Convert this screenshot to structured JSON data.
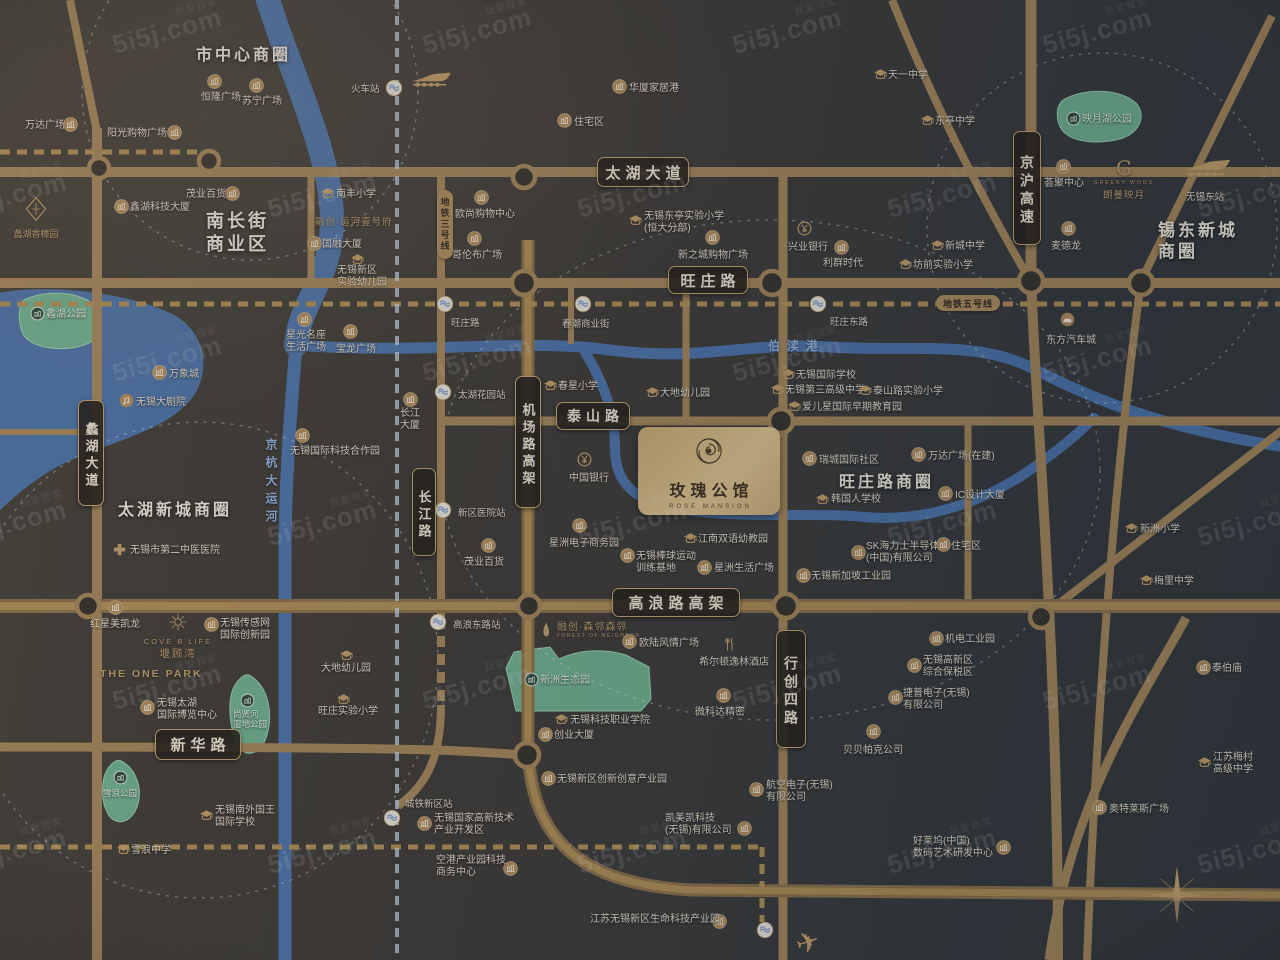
{
  "project": {
    "name": "玫瑰公馆",
    "en": "ROSE MANSION"
  },
  "watermark": {
    "brand": "5i5j.com",
    "cn": "我爱我家"
  },
  "logos": {
    "xiangzhang": "蠡湖香樟园",
    "yunhe": "融创·运河壹号府",
    "cove_en": "COVE B LIFE",
    "cove_cn": "堰顾湾",
    "onepark": "THE ONE PARK",
    "g_letter": "G",
    "g_en": "GREENY WOOD",
    "g_cn": "朗曼映月",
    "senlin_cn": "融创·森邻森邻",
    "senlin_en": "FOREST OF NEIGHBOR"
  },
  "districts": [
    {
      "ln": [
        "市中心商圈"
      ],
      "x": 196,
      "y": 46,
      "fs": 16
    },
    {
      "ln": [
        "南长街",
        "商业区"
      ],
      "x": 206,
      "y": 210,
      "fs": 18
    },
    {
      "ln": [
        "太湖新城商圈"
      ],
      "x": 118,
      "y": 501,
      "fs": 16
    },
    {
      "ln": [
        "旺庄路商圈"
      ],
      "x": 839,
      "y": 473,
      "fs": 16
    },
    {
      "ln": [
        "锡东新城",
        "商圈"
      ],
      "x": 1158,
      "y": 220,
      "fs": 17
    }
  ],
  "road_labels": [
    {
      "t": "太湖大道",
      "x": 597,
      "y": 157,
      "w": 92,
      "h": 30,
      "fs": 15,
      "v": 0
    },
    {
      "t": "旺庄路",
      "x": 668,
      "y": 266,
      "w": 80,
      "h": 28,
      "fs": 15,
      "v": 0
    },
    {
      "t": "泰山路",
      "x": 556,
      "y": 402,
      "w": 74,
      "h": 28,
      "fs": 14,
      "v": 0
    },
    {
      "t": "高浪路高架",
      "x": 612,
      "y": 588,
      "w": 128,
      "h": 29,
      "fs": 15,
      "v": 0
    },
    {
      "t": "新华路",
      "x": 155,
      "y": 729,
      "w": 86,
      "h": 31,
      "fs": 15,
      "v": 0
    },
    {
      "t": "蠡湖大道",
      "x": 78,
      "y": 400,
      "w": 26,
      "h": 106,
      "fs": 13,
      "v": 1
    },
    {
      "t": "长江路",
      "x": 412,
      "y": 468,
      "w": 24,
      "h": 88,
      "fs": 13,
      "v": 1
    },
    {
      "t": "机场路高架",
      "x": 515,
      "y": 376,
      "w": 26,
      "h": 132,
      "fs": 13,
      "v": 1
    },
    {
      "t": "京沪高速",
      "x": 1013,
      "y": 131,
      "w": 28,
      "h": 114,
      "fs": 14,
      "v": 1
    },
    {
      "t": "行创四路",
      "x": 776,
      "y": 630,
      "w": 30,
      "h": 118,
      "fs": 14,
      "v": 1
    }
  ],
  "metro_labels": [
    {
      "t": "地铁三号线",
      "x": 437,
      "y": 190,
      "v": 1
    },
    {
      "t": "地铁五号线",
      "x": 936,
      "y": 295,
      "v": 0
    }
  ],
  "river_labels": [
    {
      "t": "伯渎港",
      "x": 768,
      "y": 337,
      "v": 0
    },
    {
      "t": "京杭大运河",
      "x": 263,
      "y": 438,
      "v": 1
    }
  ],
  "plain_texts": [
    {
      "t": "无锡东站",
      "x": 1186,
      "y": 189
    }
  ],
  "stations": [
    {
      "x": 394,
      "y": 88,
      "t": "火车站",
      "tx": 351,
      "ty": 81
    },
    {
      "x": 445,
      "y": 304,
      "t": "旺庄路",
      "tx": 451,
      "ty": 315
    },
    {
      "x": 583,
      "y": 304,
      "t": "春潮商业街",
      "tx": 562,
      "ty": 316
    },
    {
      "x": 818,
      "y": 304,
      "t": "旺庄东路",
      "tx": 830,
      "ty": 314
    },
    {
      "x": 443,
      "y": 392,
      "t": "太湖花园站",
      "tx": 458,
      "ty": 387
    },
    {
      "x": 443,
      "y": 510,
      "t": "新区医院站",
      "tx": 458,
      "ty": 505
    },
    {
      "x": 438,
      "y": 622,
      "t": "高浪东路站",
      "tx": 453,
      "ty": 617
    },
    {
      "x": 392,
      "y": 818,
      "t": "城铁新区站",
      "tx": 405,
      "ty": 796
    },
    {
      "x": 765,
      "y": 930,
      "t": "",
      "tx": 0,
      "ty": 0
    }
  ],
  "pois": [
    {
      "i": "b",
      "ix": 63,
      "iy": 117,
      "tx": 25,
      "ty": 120,
      "ln": [
        "万达广场"
      ]
    },
    {
      "i": "b",
      "ix": 167,
      "iy": 125,
      "tx": 107,
      "ty": 128,
      "ln": [
        "阳光购物广场"
      ]
    },
    {
      "i": "b",
      "ix": 207,
      "iy": 74,
      "tx": 201,
      "ty": 92,
      "ln": [
        "恒隆广场"
      ]
    },
    {
      "i": "b",
      "ix": 249,
      "iy": 78,
      "tx": 242,
      "ty": 96,
      "ln": [
        "苏宁广场"
      ]
    },
    {
      "i": "b",
      "ix": 225,
      "iy": 186,
      "tx": 186,
      "ty": 189,
      "ln": [
        "茂业百货"
      ]
    },
    {
      "i": "b",
      "ix": 114,
      "iy": 199,
      "tx": 130,
      "ty": 202,
      "ln": [
        "鑫湖科技大厦"
      ]
    },
    {
      "i": "b",
      "ix": 152,
      "iy": 365,
      "tx": 169,
      "ty": 369,
      "ln": [
        "万象城"
      ]
    },
    {
      "i": "th",
      "ix": 119,
      "iy": 393,
      "tx": 136,
      "ty": 397,
      "ln": [
        "无锡大剧院"
      ]
    },
    {
      "i": "b",
      "ix": 297,
      "iy": 312,
      "tx": 286,
      "ty": 330,
      "ln": [
        "星光名座",
        "生活广场"
      ]
    },
    {
      "i": "b",
      "ix": 343,
      "iy": 324,
      "tx": 336,
      "ty": 344,
      "ln": [
        "宝龙广场"
      ]
    },
    {
      "i": "b",
      "ix": 612,
      "iy": 79,
      "tx": 629,
      "ty": 83,
      "ln": [
        "华厦家居港"
      ]
    },
    {
      "i": "b",
      "ix": 557,
      "iy": 113,
      "tx": 574,
      "ty": 117,
      "ln": [
        "住宅区"
      ]
    },
    {
      "i": "b",
      "ix": 474,
      "iy": 190,
      "tx": 455,
      "ty": 209,
      "ln": [
        "欧尚购物中心"
      ]
    },
    {
      "i": "b",
      "ix": 467,
      "iy": 231,
      "tx": 452,
      "ty": 250,
      "ln": [
        "哥伦布广场"
      ]
    },
    {
      "i": "b",
      "ix": 307,
      "iy": 236,
      "tx": 322,
      "ty": 239,
      "ln": [
        "国融大厦"
      ]
    },
    {
      "i": "b",
      "ix": 705,
      "iy": 230,
      "tx": 678,
      "ty": 250,
      "ln": [
        "新之城购物广场"
      ]
    },
    {
      "i": "b",
      "ix": 834,
      "iy": 240,
      "tx": 823,
      "ty": 258,
      "ln": [
        "利群时代"
      ]
    },
    {
      "i": "bank",
      "ix": 797,
      "iy": 221,
      "tx": 788,
      "ty": 242,
      "ln": [
        "兴业银行"
      ]
    },
    {
      "i": "b",
      "ix": 1056,
      "iy": 159,
      "tx": 1044,
      "ty": 178,
      "ln": [
        "荟聚中心"
      ]
    },
    {
      "i": "b",
      "ix": 1061,
      "iy": 221,
      "tx": 1051,
      "ty": 241,
      "ln": [
        "麦德龙"
      ]
    },
    {
      "i": "b",
      "ix": 403,
      "iy": 392,
      "tx": 400,
      "ty": 408,
      "ln": [
        "长江",
        "大厦"
      ]
    },
    {
      "i": "b",
      "ix": 481,
      "iy": 538,
      "tx": 464,
      "ty": 557,
      "ln": [
        "茂业百货"
      ]
    },
    {
      "i": "b",
      "ix": 802,
      "iy": 451,
      "tx": 819,
      "ty": 455,
      "ln": [
        "瑞城国际社区"
      ]
    },
    {
      "i": "b",
      "ix": 911,
      "iy": 447,
      "tx": 928,
      "ty": 451,
      "ln": [
        "万达广场(在建)"
      ]
    },
    {
      "i": "b",
      "ix": 938,
      "iy": 486,
      "tx": 955,
      "ty": 490,
      "ln": [
        "IC设计大厦"
      ]
    },
    {
      "i": "b",
      "ix": 572,
      "iy": 518,
      "tx": 549,
      "ty": 538,
      "ln": [
        "星洲电子商务园"
      ]
    },
    {
      "i": "bank",
      "ix": 577,
      "iy": 452,
      "tx": 569,
      "ty": 473,
      "ln": [
        "中国银行"
      ]
    },
    {
      "i": "b",
      "ix": 851,
      "iy": 545,
      "tx": 866,
      "ty": 541,
      "ln": [
        "SK海力士半导体",
        "(中国)有限公司"
      ]
    },
    {
      "i": "b",
      "ix": 936,
      "iy": 537,
      "tx": 951,
      "ty": 541,
      "ln": [
        "住宅区"
      ]
    },
    {
      "i": "b",
      "ix": 796,
      "iy": 568,
      "tx": 811,
      "ty": 571,
      "ln": [
        "无锡新加坡工业园"
      ]
    },
    {
      "i": "b",
      "ix": 929,
      "iy": 631,
      "tx": 945,
      "ty": 634,
      "ln": [
        "机电工业园"
      ]
    },
    {
      "i": "b",
      "ix": 907,
      "iy": 658,
      "tx": 923,
      "ty": 655,
      "ln": [
        "无锡高新区",
        "综合保税区"
      ]
    },
    {
      "i": "b",
      "ix": 888,
      "iy": 690,
      "tx": 903,
      "ty": 688,
      "ln": [
        "捷普电子(无锡)",
        "有限公司"
      ]
    },
    {
      "i": "b",
      "ix": 866,
      "iy": 724,
      "tx": 843,
      "ty": 745,
      "ln": [
        "贝贝帕克公司"
      ]
    },
    {
      "i": "b",
      "ix": 749,
      "iy": 782,
      "tx": 766,
      "ty": 780,
      "ln": [
        "航空电子(无锡)",
        "有限公司"
      ]
    },
    {
      "i": "b",
      "ix": 996,
      "iy": 840,
      "tx": 913,
      "ty": 836,
      "ln": [
        "好莱坞(中国)",
        "数码艺术研发中心"
      ]
    },
    {
      "i": "b",
      "ix": 622,
      "iy": 634,
      "tx": 639,
      "ty": 638,
      "ln": [
        "欧陆风情广场"
      ]
    },
    {
      "i": "fk",
      "ix": 723,
      "iy": 637,
      "tx": 699,
      "ty": 657,
      "ln": [
        "希尔顿逸林酒店"
      ]
    },
    {
      "i": "b",
      "ix": 716,
      "iy": 688,
      "tx": 695,
      "ty": 707,
      "ln": [
        "微科达精密"
      ]
    },
    {
      "i": "b",
      "ix": 538,
      "iy": 727,
      "tx": 554,
      "ty": 730,
      "ln": [
        "创业大厦"
      ]
    },
    {
      "i": "b",
      "ix": 541,
      "iy": 771,
      "tx": 557,
      "ty": 774,
      "ln": [
        "无锡新区创新创意产业园"
      ]
    },
    {
      "i": "b",
      "ix": 417,
      "iy": 816,
      "tx": 434,
      "ty": 813,
      "ln": [
        "无锡国家高新技术",
        "产业开发区"
      ]
    },
    {
      "i": "b",
      "ix": 503,
      "iy": 861,
      "tx": 436,
      "ty": 855,
      "ln": [
        "空港产业园科技",
        "商务中心"
      ]
    },
    {
      "i": "b",
      "ix": 712,
      "iy": 914,
      "tx": 590,
      "ty": 914,
      "ln": [
        "江苏无锡新区生命科技产业园"
      ]
    },
    {
      "i": "b",
      "ix": 737,
      "iy": 821,
      "tx": 665,
      "ty": 813,
      "ln": [
        "凯美凯科技",
        "(无锡)有限公司"
      ]
    },
    {
      "i": "b",
      "ix": 108,
      "iy": 600,
      "tx": 90,
      "ty": 619,
      "ln": [
        "红星美凯龙"
      ]
    },
    {
      "i": "b",
      "ix": 204,
      "iy": 617,
      "tx": 220,
      "ty": 618,
      "ln": [
        "无锡传感网",
        "国际创新园"
      ]
    },
    {
      "i": "b",
      "ix": 140,
      "iy": 700,
      "tx": 157,
      "ty": 698,
      "ln": [
        "无锡太湖",
        "国际博览中心"
      ]
    },
    {
      "i": "b",
      "ix": 1092,
      "iy": 800,
      "tx": 1109,
      "ty": 804,
      "ln": [
        "奥特莱斯广场"
      ]
    },
    {
      "i": "b",
      "ix": 1196,
      "iy": 660,
      "tx": 1212,
      "ty": 663,
      "ln": [
        "泰伯庙"
      ]
    },
    {
      "i": "car",
      "ix": 1060,
      "iy": 312,
      "tx": 1046,
      "ty": 335,
      "ln": [
        "东方汽车城"
      ]
    },
    {
      "i": "b",
      "ix": 295,
      "iy": 428,
      "tx": 290,
      "ty": 446,
      "ln": [
        "无锡国际科技合作园"
      ]
    },
    {
      "i": "b",
      "ix": 697,
      "iy": 560,
      "tx": 714,
      "ty": 563,
      "ln": [
        "星洲生活广场"
      ]
    },
    {
      "i": "s",
      "ix": 320,
      "iy": 186,
      "tx": 336,
      "ty": 189,
      "ln": [
        "南丰小学"
      ]
    },
    {
      "i": "s",
      "ix": 350,
      "iy": 252,
      "tx": 337,
      "ty": 265,
      "ln": [
        "无锡新区",
        "实验幼儿园"
      ]
    },
    {
      "i": "s",
      "ix": 628,
      "iy": 213,
      "tx": 644,
      "ty": 211,
      "ln": [
        "无锡东亭实验小学",
        "(恒大分部)"
      ]
    },
    {
      "i": "s",
      "ix": 873,
      "iy": 67,
      "tx": 888,
      "ty": 70,
      "ln": [
        "天一中学"
      ]
    },
    {
      "i": "s",
      "ix": 920,
      "iy": 113,
      "tx": 935,
      "ty": 116,
      "ln": [
        "东亭中学"
      ]
    },
    {
      "i": "s",
      "ix": 930,
      "iy": 238,
      "tx": 945,
      "ty": 241,
      "ln": [
        "新城中学"
      ]
    },
    {
      "i": "s",
      "ix": 898,
      "iy": 257,
      "tx": 913,
      "ty": 260,
      "ln": [
        "坊前实验小学"
      ]
    },
    {
      "i": "s",
      "ix": 543,
      "iy": 378,
      "tx": 558,
      "ty": 381,
      "ln": [
        "春星小学"
      ]
    },
    {
      "i": "s",
      "ix": 645,
      "iy": 385,
      "tx": 660,
      "ty": 388,
      "ln": [
        "大地幼儿园"
      ]
    },
    {
      "i": "s",
      "ix": 781,
      "iy": 367,
      "tx": 796,
      "ty": 370,
      "ln": [
        "无锡国际学校"
      ]
    },
    {
      "i": "s",
      "ix": 770,
      "iy": 382,
      "tx": 785,
      "ty": 385,
      "ln": [
        "无锡第三高级中学"
      ]
    },
    {
      "i": "s",
      "ix": 858,
      "iy": 383,
      "tx": 873,
      "ty": 386,
      "ln": [
        "泰山路实验小学"
      ]
    },
    {
      "i": "s",
      "ix": 787,
      "iy": 399,
      "tx": 802,
      "ty": 402,
      "ln": [
        "爱儿星国际早期教育园"
      ]
    },
    {
      "i": "s",
      "ix": 815,
      "iy": 492,
      "tx": 831,
      "ty": 494,
      "ln": [
        "韩国人学校"
      ]
    },
    {
      "i": "s",
      "ix": 683,
      "iy": 531,
      "tx": 698,
      "ty": 534,
      "ln": [
        "江南双语幼教园"
      ]
    },
    {
      "i": "b",
      "ix": 620,
      "iy": 548,
      "tx": 636,
      "ty": 551,
      "ln": [
        "无锡棒球运动",
        "训练基地"
      ]
    },
    {
      "i": "s",
      "ix": 554,
      "iy": 712,
      "tx": 570,
      "ty": 715,
      "ln": [
        "无锡科技职业学院"
      ]
    },
    {
      "i": "s",
      "ix": 116,
      "iy": 842,
      "tx": 131,
      "ty": 845,
      "ln": [
        "雪浪中学"
      ]
    },
    {
      "i": "s",
      "ix": 199,
      "iy": 808,
      "tx": 215,
      "ty": 805,
      "ln": [
        "无锡南外国王",
        "国际学校"
      ]
    },
    {
      "i": "s",
      "ix": 336,
      "iy": 692,
      "tx": 318,
      "ty": 706,
      "ln": [
        "旺庄实验小学"
      ]
    },
    {
      "i": "s",
      "ix": 339,
      "iy": 648,
      "tx": 321,
      "ty": 663,
      "ln": [
        "大地幼儿园"
      ]
    },
    {
      "i": "s",
      "ix": 1124,
      "iy": 521,
      "tx": 1140,
      "ty": 524,
      "ln": [
        "新洲小学"
      ]
    },
    {
      "i": "s",
      "ix": 1139,
      "iy": 573,
      "tx": 1154,
      "ty": 576,
      "ln": [
        "梅里中学"
      ]
    },
    {
      "i": "s",
      "ix": 1197,
      "iy": 755,
      "tx": 1213,
      "ty": 752,
      "ln": [
        "江苏梅村",
        "高级中学"
      ]
    },
    {
      "i": "h",
      "ix": 112,
      "iy": 542,
      "tx": 130,
      "ty": 545,
      "ln": [
        "无锡市第二中医医院"
      ]
    },
    {
      "i": "p",
      "ix": 30,
      "iy": 306,
      "tx": 46,
      "ty": 309,
      "ln": [
        "蠡湖公园"
      ],
      "park": 1
    },
    {
      "i": "p",
      "ix": 1066,
      "iy": 111,
      "tx": 1082,
      "ty": 114,
      "ln": [
        "映月湖公园"
      ],
      "park": 1
    },
    {
      "i": "p",
      "ix": 524,
      "iy": 672,
      "tx": 540,
      "ty": 675,
      "ln": [
        "新洲生态园"
      ],
      "park": 1
    },
    {
      "i": "p",
      "ix": 240,
      "iy": 693,
      "tx": 233,
      "ty": 710,
      "ln": [
        "尚贤河",
        "湿地公园"
      ],
      "park": 1,
      "small": 1
    },
    {
      "i": "p",
      "ix": 113,
      "iy": 770,
      "tx": 103,
      "ty": 789,
      "ln": [
        "雪浪公园"
      ],
      "park": 1,
      "small": 1
    }
  ]
}
